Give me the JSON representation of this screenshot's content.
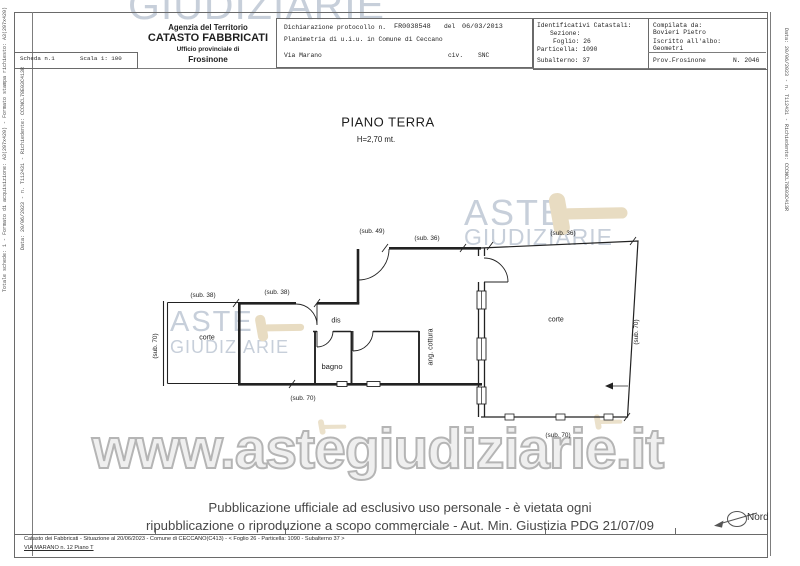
{
  "colors": {
    "watermark_blue": "#c7cfda",
    "gavel_beige": "#e8dcc2",
    "plan_line": "#222222",
    "frame_line": "#7d7d7d"
  },
  "header": {
    "scheda": "Scheda n.1",
    "scala": "Scala 1: 100",
    "agency": {
      "line1": "Agenzia del Territorio",
      "line2": "CATASTO FABBRICATI",
      "line3": "Ufficio provinciale di",
      "line4": "Frosinone"
    },
    "declaration": {
      "label": "Dichiarazione protocollo n.",
      "protocol": "FR0038548",
      "del_word": "del",
      "date": "06/03/2013",
      "planimetria": "Planimetria di u.i.u. in Comune di Ceccano",
      "street": "Via Marano",
      "civ_label": "civ.",
      "civ_value": "SNC"
    },
    "catastali": {
      "title": "Identificativi Catastali:",
      "sezione": "Sezione:",
      "foglio": "Foglio: 26",
      "particella": "Particella: 1090",
      "subalterno": "Subalterno: 37"
    },
    "compilata": {
      "title": "Compilata da:",
      "name": "Bovieri Pietro",
      "albo_label": "Iscritto all'albo:",
      "albo_value": "Geometri",
      "prov": "Prov.Frosinone",
      "numero": "N. 2046"
    }
  },
  "plan": {
    "title": "PIANO TERRA",
    "height_label": "H=2,70 mt.",
    "labels": {
      "sub38_a": "(sub. 38)",
      "sub38_b": "(sub. 38)",
      "sub49": "(sub. 49)",
      "sub36_a": "(sub. 36)",
      "sub36_b": "(sub. 36)",
      "sub70_left": "(sub. 70)",
      "sub70_bottom": "(sub. 70)",
      "sub70_right": "(sub. 70)",
      "sub70_corte": "(sub. 70)",
      "corte_left": "corte",
      "corte_right": "corte",
      "dis": "dis",
      "bagno": "bagno",
      "cottura": "ang. cottura"
    }
  },
  "watermark": {
    "top": "GIUDIZIARIE",
    "aste_right": "ASTE",
    "giudiziarie_right": "GIUDIZIARIE",
    "aste_left": "ASTE",
    "giudiziarie_left": "GIUDIZIARIE",
    "url": "www.astegiudiziarie.it"
  },
  "compass": {
    "label": "Nord"
  },
  "footer": {
    "notice_line1": "Pubblicazione ufficiale ad esclusivo uso personale - è vietata ogni",
    "notice_line2": "ripubblicazione o riproduzione a scopo commerciale - Aut. Min. Giustizia PDG 21/07/09",
    "strip_line1": "Catasto dei Fabbricati - Situazione al 20/06/2023 - Comune di CECCANO(C413) - < Foglio 26 - Particella: 1090 - Subalterno 37 >",
    "strip_line2": "VIA MARANO n. 12 Piano T"
  },
  "side_text": {
    "left_outer": "Totale schede: 1 - Formato di acquisizione: A3(297x420) - Formato stampa richiesto: A3(297x420)",
    "left_inner": "Data: 20/06/2023 - n. T112431 - Richiedente: CCCNCL78E03C413R",
    "right": "Data: 20/06/2023 - n. T112431 - Richiedente: CCCNCL78E03C413R"
  }
}
